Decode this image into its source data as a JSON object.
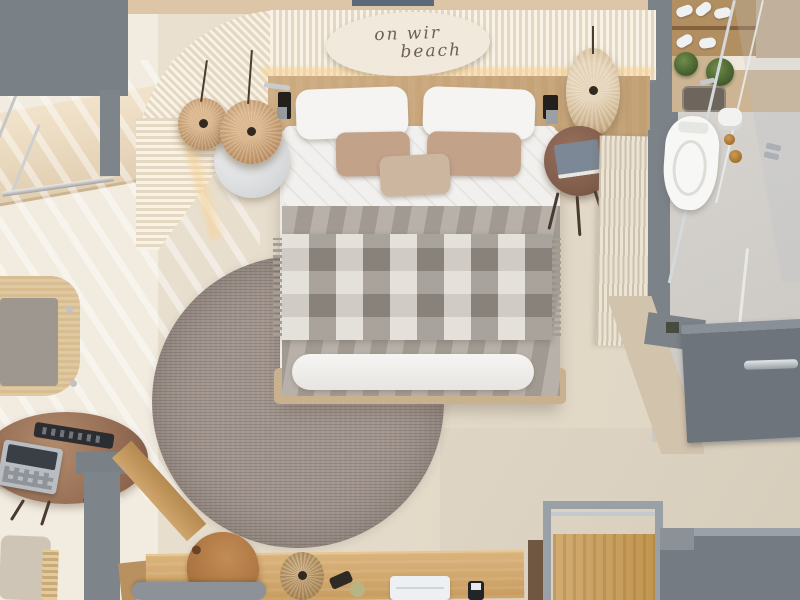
{
  "scene": {
    "type": "3D architectural render, top-down plan view",
    "subject": "Beach-style hotel guest room: bedroom with curved slatted feature wall, work desk, lounge corner and en-suite bathroom"
  },
  "sign": {
    "line1": "on wir",
    "line2": "beach"
  },
  "objects": [
    {
      "name": "curved-slat-wall",
      "label": "Curved cream slatted feature wall with warm LED glow"
    },
    {
      "name": "oval-sign",
      "label": "Oval plaque with cursive script"
    },
    {
      "name": "double-bed",
      "label": "Double bed with white pillows, beige cushions, grey blanket and plaid throw"
    },
    {
      "name": "round-rug",
      "label": "Large round grey-brown woven rug"
    },
    {
      "name": "marble-side-table",
      "label": "Round white marble side table"
    },
    {
      "name": "pendant-lamps",
      "label": "Three rattan pendant lamps"
    },
    {
      "name": "dark-wood-side-table",
      "label": "Round dark wood side table with book"
    },
    {
      "name": "macrame-hanging",
      "label": "Cream macrame wall hanging"
    },
    {
      "name": "lounge-chair",
      "label": "Rattan lounge chair with grey cushion"
    },
    {
      "name": "coffee-table",
      "label": "Round wooden coffee table with remote control and tablet"
    },
    {
      "name": "window-daybed",
      "label": "Sunlit window bench with chrome rail"
    },
    {
      "name": "desk",
      "label": "Wooden desk with laptop, smartphone, woven lamp and bottles"
    },
    {
      "name": "desk-chairs",
      "label": "Caramel leather chair and grey chair"
    },
    {
      "name": "luggage-rack",
      "label": "Metal-framed wooden luggage rack"
    },
    {
      "name": "grey-cabinet",
      "label": "Grey cabinet"
    },
    {
      "name": "toilet",
      "label": "Wall-hung toilet with bronze flush knobs and paper roll"
    },
    {
      "name": "shower",
      "label": "Glass walk-in shower with chrome handle"
    },
    {
      "name": "vanity",
      "label": "Vanity counter with dark sink, potted plants and shoe shelf"
    },
    {
      "name": "bathroom-door",
      "label": "Grey bathroom door with chrome lever handle"
    }
  ],
  "colors": {
    "floor_bedroom": "#e6dccc",
    "floor_sunlit": "#f1ebe0",
    "floor_bathroom": "#d6d3ce",
    "floor_concrete": "#ddd4c3",
    "wall_grey": "#798086",
    "slat_cream": "#f8f2e7",
    "slat_shadow": "#e4d8c2",
    "led_glow": "#f6d398",
    "headboard_wood": "#c9a77b",
    "bed_white": "#f1f0ee",
    "pillow_tan": "#c2a289",
    "blanket_grey": "#aba49b",
    "plaid": "#b6afa6",
    "rug": "#a2968f",
    "desk_wood": "#d0a76c",
    "rattan": "#c8a87c",
    "door_grey": "#6e747b",
    "sign_bg": "#f1e9db",
    "sign_text": "#6e6152"
  }
}
